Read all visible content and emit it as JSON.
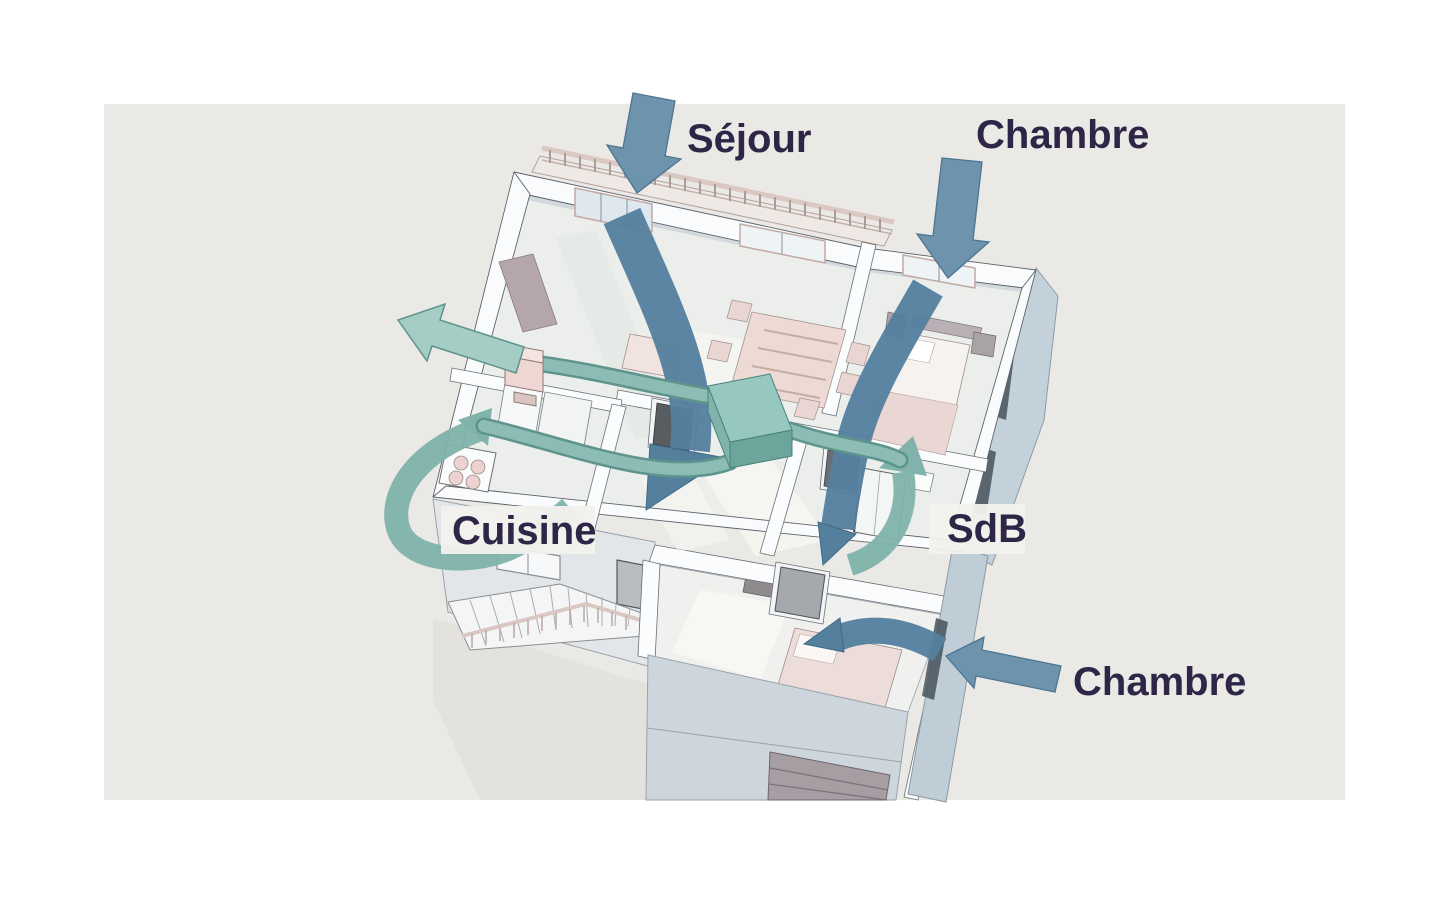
{
  "figure": {
    "alt": "Vue 3D en coupe d'une maison montrant les flux de ventilation (VMC double flux)",
    "canvas": {
      "page_background": "#ffffff",
      "background": "#ebe9e5"
    },
    "labels": {
      "sejour": "Séjour",
      "chambre_haut": "Chambre",
      "cuisine": "Cuisine",
      "sdb": "SdB",
      "chambre_bas": "Chambre"
    },
    "colors": {
      "label_text": "#2e2647",
      "label_box_background": "#f3f1ed",
      "fresh_air_arrow": "#6e93ad",
      "indoor_airflow": "#54809e",
      "extract_duct": "#85b7b0",
      "extract_swirl": "#7fb3ab",
      "vmc_unit": "#96c8c0",
      "exhaust_arrow": "#a5ccc5",
      "walls": "#fafbfd",
      "facade": "#c3d1da",
      "garage_door": "#a79ea4",
      "furniture": "#ecdcda"
    },
    "airflow": {
      "fresh_air_inlet_rooms": [
        "Séjour",
        "Chambre",
        "Chambre"
      ],
      "extraction_rooms": [
        "Cuisine",
        "SdB"
      ],
      "exhaust_direction": "extérieur"
    }
  }
}
